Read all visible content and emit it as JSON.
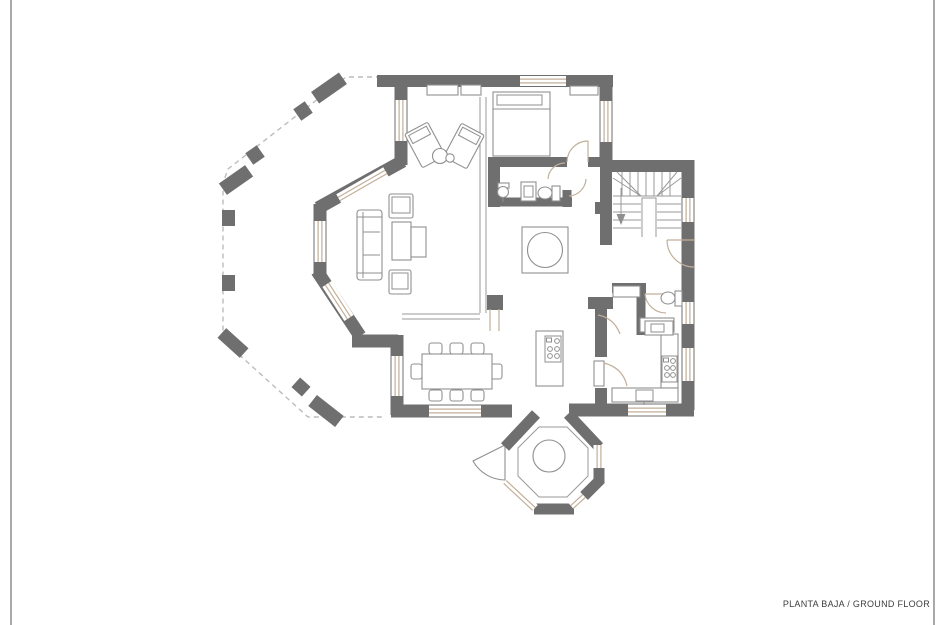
{
  "page": {
    "background": "#ffffff",
    "side_border_color": "#a9a9a9"
  },
  "caption": {
    "text": "PLANTA BAJA / GROUND FLOOR",
    "color": "#3d3d3d"
  },
  "plan": {
    "title": "ground floor plan drawing",
    "colors": {
      "wall": "#6f6f6f",
      "window_frame": "#c2af99",
      "furniture_line": "#8f8f8f",
      "dashed_line": "#bcbcbc",
      "partition": "#9a9a9a"
    }
  }
}
